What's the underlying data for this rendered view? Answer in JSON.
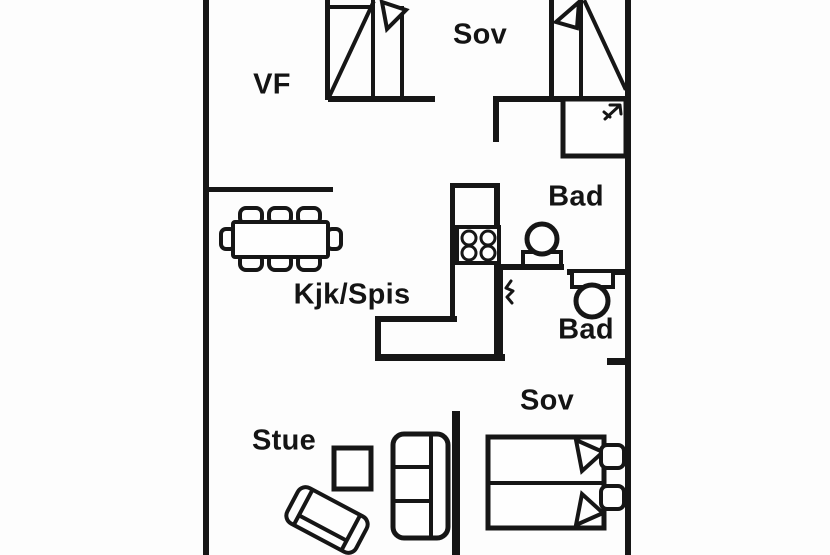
{
  "plan_title": "Apartment floor plan",
  "colors": {
    "line": "#161616",
    "background": "#fdfdfd",
    "text": "#141414"
  },
  "rooms": [
    {
      "id": "vf",
      "label": "VF"
    },
    {
      "id": "sov-top",
      "label": "Sov"
    },
    {
      "id": "bad-upper",
      "label": "Bad"
    },
    {
      "id": "kjk-spis",
      "label": "Kjk/Spis"
    },
    {
      "id": "bad-lower",
      "label": "Bad"
    },
    {
      "id": "sov-right",
      "label": "Sov"
    },
    {
      "id": "stue",
      "label": "Stue"
    }
  ],
  "fixtures": [
    "single-bed-icon (top left)",
    "single-bed-icon (top right)",
    "wardrobe-icon",
    "basin-sink-icon",
    "toilet-icon",
    "stove-icon (4 burners)",
    "kitchen-counter",
    "dining-table-icon (8 chairs)",
    "coffee-table-icon",
    "sofa-icon (3 seats)",
    "loveseat-icon (rotated)",
    "double-bed-icon (2 pillows)"
  ]
}
